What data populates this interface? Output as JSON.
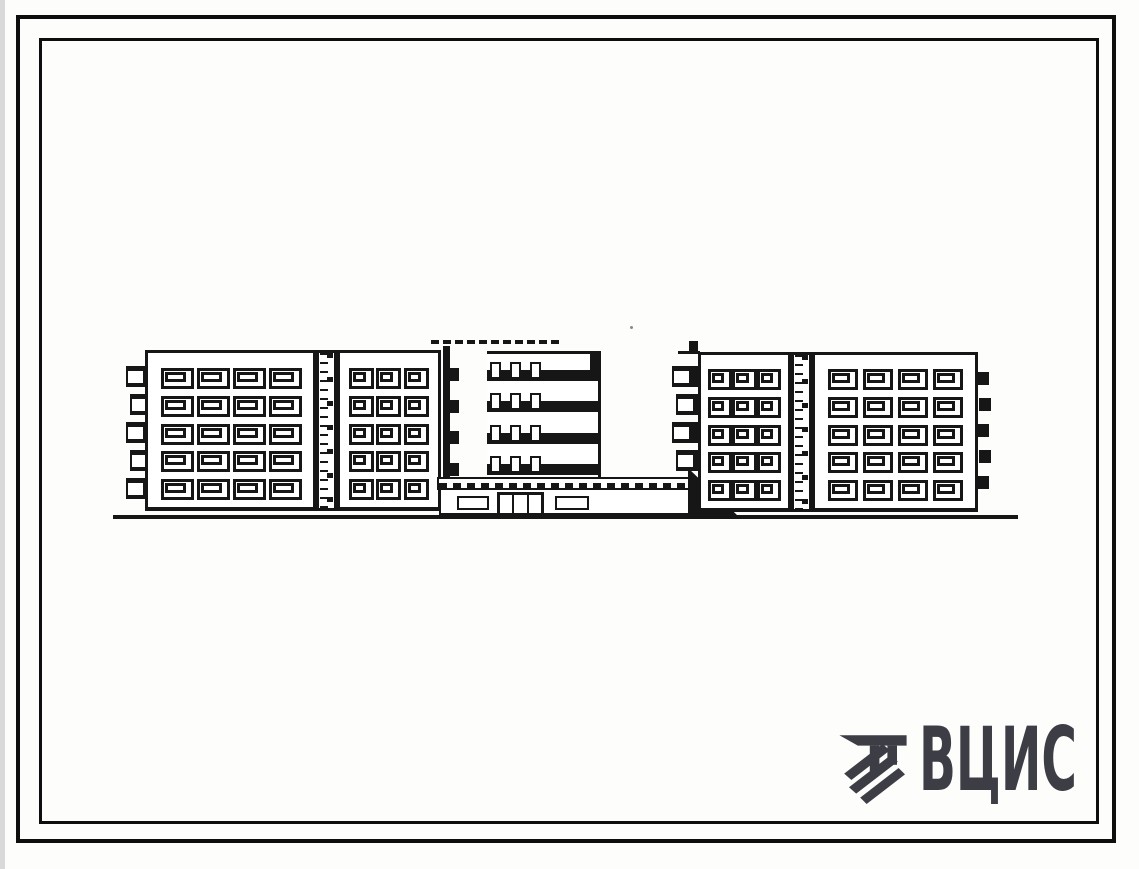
{
  "sheet": {
    "kind_label": "building elevation drawing",
    "paper_color": "#fdfdfc",
    "ink_color": "#161616",
    "scan_edge_color": "#d9d9d9"
  },
  "logo": {
    "text": "ВЦИС",
    "color": "#3d3d45",
    "emblem": "hatched-bar-mark"
  },
  "drawing": {
    "blocks": [
      {
        "id": "left-a",
        "cols": 4,
        "rows": 5
      },
      {
        "id": "left-b",
        "cols": 3,
        "rows": 5
      },
      {
        "id": "right-c",
        "cols": 3,
        "rows": 5
      },
      {
        "id": "right-d",
        "cols": 4,
        "rows": 5
      }
    ],
    "tower": {
      "floors": 4,
      "doors_per_floor": 3,
      "notches": 4
    },
    "podium": {
      "windows": 2,
      "door_panels": 3
    },
    "balconies": {
      "left_stack": 5,
      "right_stack": 4,
      "right_edge_ticks": 5
    }
  }
}
